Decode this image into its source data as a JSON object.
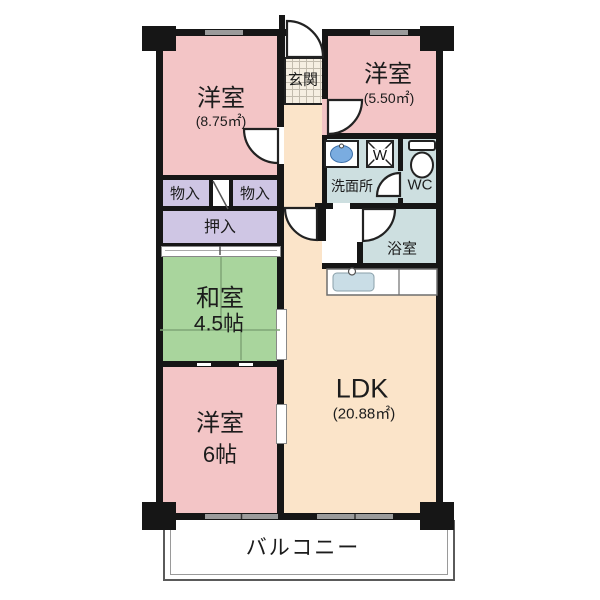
{
  "colors": {
    "wall": "#161616",
    "pink": "#f3c5c6",
    "lavender": "#cfc6e4",
    "green": "#a9d59d",
    "cream": "#fbe4c9",
    "wet": "#cddfe0",
    "sink": "#7aace0",
    "window": "#9b9b9b"
  },
  "floorplan": {
    "bedroom_nw": {
      "name": "洋室",
      "area": "(8.75㎡)"
    },
    "bedroom_ne": {
      "name": "洋室",
      "area": "(5.50㎡)"
    },
    "entrance": {
      "name": "玄関"
    },
    "washroom": {
      "name": "洗面所"
    },
    "wc": {
      "name": "WC"
    },
    "bathroom": {
      "name": "浴室"
    },
    "storage_left": {
      "name": "物入"
    },
    "storage_right": {
      "name": "物入"
    },
    "closet": {
      "name": "押入"
    },
    "japanese_room": {
      "name": "和室",
      "area": "4.5帖"
    },
    "bedroom_sw": {
      "name": "洋室",
      "area": "6帖"
    },
    "ldk": {
      "name": "LDK",
      "area": "(20.88㎡)"
    },
    "balcony": {
      "name": "バルコニー"
    },
    "washer_label": "W"
  }
}
